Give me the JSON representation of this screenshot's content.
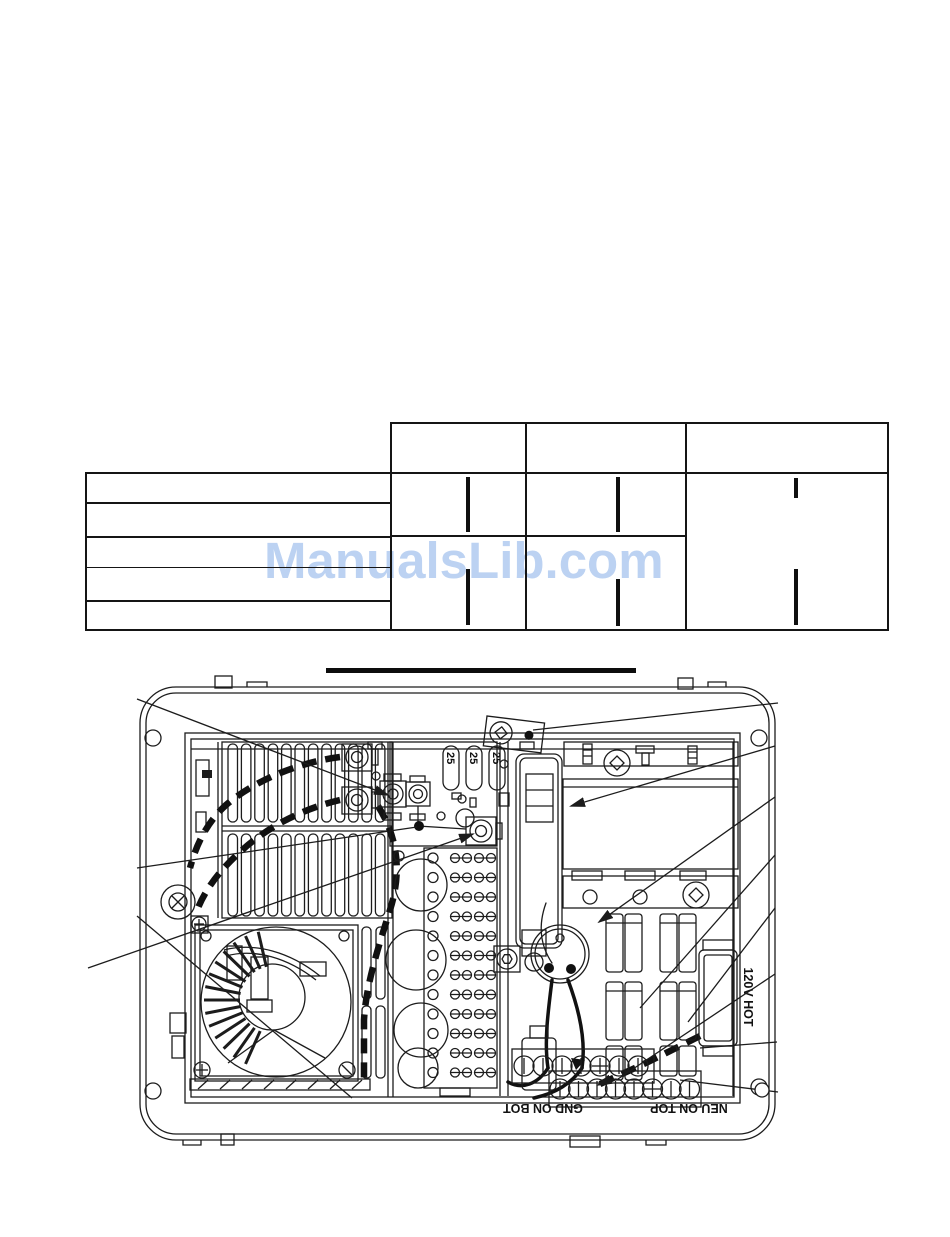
{
  "watermark": {
    "text": "ManualsLib.com",
    "color": "#bcd2f2"
  },
  "table": {
    "left_block_rows": 5,
    "right_block_columns": 3,
    "has_header_band": true
  },
  "diagram": {
    "fuse_labels": [
      "25",
      "25",
      "25"
    ],
    "labels": {
      "receptacle": "120V HOT",
      "ground": "GND ON BOT",
      "neutral": "NEU ON TOP"
    }
  },
  "colors": {
    "line": "#1c1c1c",
    "watermark": "#bcd2f2"
  }
}
